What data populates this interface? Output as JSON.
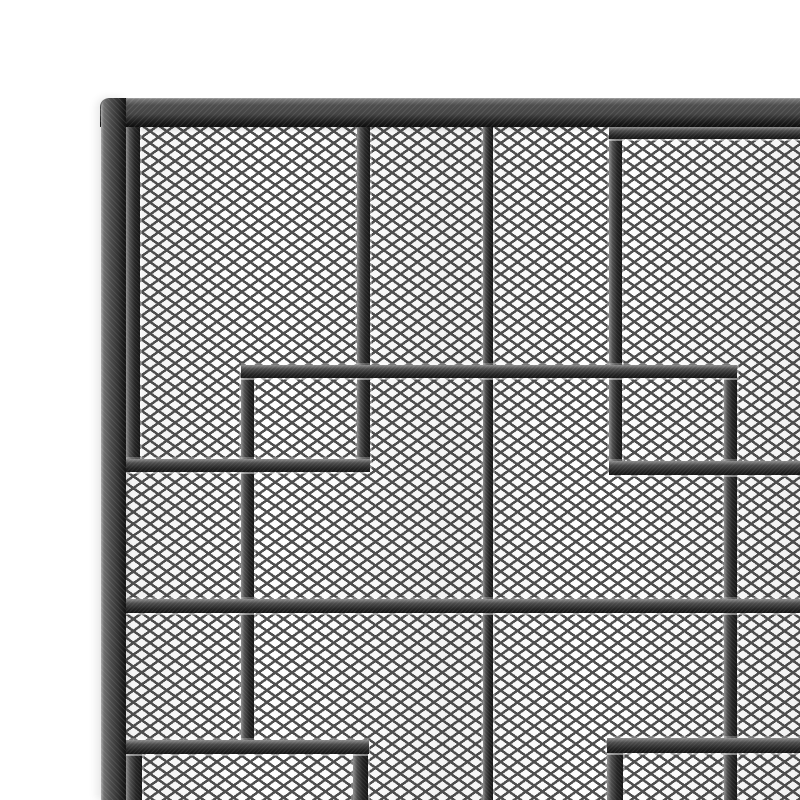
{
  "meta": {
    "type": "product-photo",
    "description": "Close-up of the top-left corner of a black brushed-iron fireplace screen: an outer frame with diamond expanded-metal mesh and a decorative pattern of overlapping rectangular bars.",
    "subject": "fire screen corner detail",
    "finish": "brushed black pewter iron"
  },
  "canvas": {
    "width": 800,
    "height": 800,
    "background": "#ffffff"
  },
  "palette": {
    "bar_highlight": "#8e8e8e",
    "bar_mid": "#4c4c4c",
    "bar_dark": "#262626",
    "bar_edge": "#151515",
    "frame_highlight": "#a9a9a9",
    "frame_face": "#4e4e4e",
    "frame_lip": "#161616",
    "mesh_line": "#4f4f4f",
    "mesh_bg": "#ffffff"
  },
  "mesh": {
    "x": 118,
    "y": 119,
    "width": 682,
    "height": 681,
    "cell_width": 16.7,
    "cell_height": 11.9,
    "line_thickness": 2.5
  },
  "bars": [
    {
      "id": "outer-top-rail",
      "kind": "frame",
      "orientation": "h",
      "x": 100,
      "y": 98,
      "w": 700,
      "h": 29
    },
    {
      "id": "outer-left-stile",
      "kind": "frame",
      "orientation": "v",
      "x": 101,
      "y": 98,
      "w": 25,
      "h": 702
    },
    {
      "id": "rect-a-left",
      "kind": "inner",
      "orientation": "v",
      "x": 126,
      "y": 126,
      "w": 14,
      "h": 346
    },
    {
      "id": "rect-a-right",
      "kind": "inner",
      "orientation": "v",
      "x": 357,
      "y": 126,
      "w": 13,
      "h": 346
    },
    {
      "id": "rect-a-bottom",
      "kind": "inner",
      "orientation": "h",
      "x": 126,
      "y": 459,
      "w": 244,
      "h": 13
    },
    {
      "id": "rect-c-left",
      "kind": "inner",
      "orientation": "v",
      "x": 609,
      "y": 125,
      "w": 13,
      "h": 350
    },
    {
      "id": "rect-c-top",
      "kind": "inner",
      "orientation": "h",
      "x": 609,
      "y": 127,
      "w": 191,
      "h": 12
    },
    {
      "id": "rect-c-bottom",
      "kind": "inner",
      "orientation": "h",
      "x": 609,
      "y": 461,
      "w": 191,
      "h": 14
    },
    {
      "id": "center-mullion",
      "kind": "inner",
      "orientation": "v",
      "x": 483,
      "y": 124,
      "w": 10,
      "h": 676
    },
    {
      "id": "rect-b-top",
      "kind": "inner",
      "orientation": "h",
      "x": 241,
      "y": 365,
      "w": 496,
      "h": 13
    },
    {
      "id": "rect-b-left",
      "kind": "inner",
      "orientation": "v",
      "x": 241,
      "y": 365,
      "w": 13,
      "h": 382
    },
    {
      "id": "rect-b-right",
      "kind": "inner",
      "orientation": "v",
      "x": 724,
      "y": 365,
      "w": 13,
      "h": 435
    },
    {
      "id": "middle-rail",
      "kind": "inner",
      "orientation": "h",
      "x": 125,
      "y": 599,
      "w": 675,
      "h": 14
    },
    {
      "id": "rect-e-top",
      "kind": "inner",
      "orientation": "h",
      "x": 125,
      "y": 740,
      "w": 244,
      "h": 14
    },
    {
      "id": "rect-e-left",
      "kind": "inner",
      "orientation": "v",
      "x": 126,
      "y": 740,
      "w": 16,
      "h": 60
    },
    {
      "id": "rect-e-right",
      "kind": "inner",
      "orientation": "v",
      "x": 353,
      "y": 740,
      "w": 15,
      "h": 60
    },
    {
      "id": "rect-d-top",
      "kind": "inner",
      "orientation": "h",
      "x": 607,
      "y": 738,
      "w": 193,
      "h": 15
    },
    {
      "id": "rect-d-left",
      "kind": "inner",
      "orientation": "v",
      "x": 607,
      "y": 738,
      "w": 16,
      "h": 62
    }
  ]
}
